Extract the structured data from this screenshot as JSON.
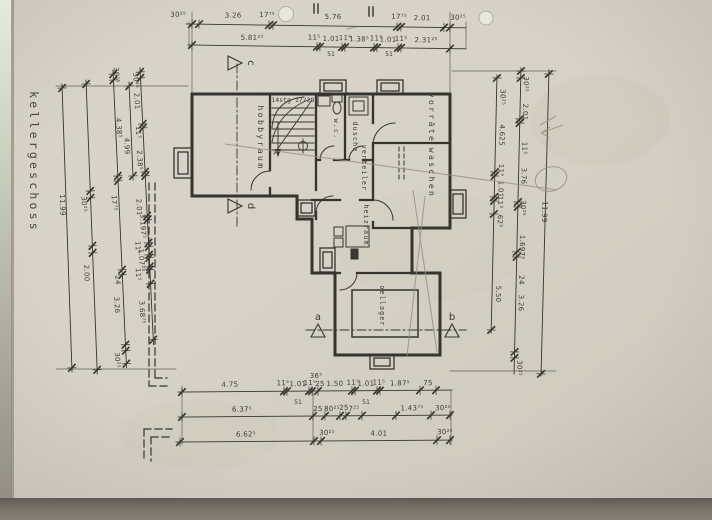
{
  "title": "kellergeschoss",
  "rooms": {
    "hobbyraum": "hobbyraum",
    "stairs": "14stg 17/28",
    "wc": "w.c.",
    "dusche": "dusche",
    "vorraete": "vorräte",
    "waschen": "waschen",
    "verteiler": "verteiler",
    "heizraum": "heizraum",
    "oellager": "oellager"
  },
  "section_markers": {
    "a": "a",
    "b": "b",
    "c": "c",
    "d": "d"
  },
  "dims": {
    "top1": [
      "30²⁵",
      "3.26",
      "17⁷⁵",
      "5.76",
      "17⁷⁵",
      "2.01",
      "30²⁵"
    ],
    "top2": [
      "5.81²⁵",
      "11⁵",
      "1.01",
      "11⁵",
      "1.38⁵",
      "11⁵",
      "1.01",
      "11⁵",
      "2.31²⁵"
    ],
    "top2_sub": [
      "51",
      "51"
    ],
    "bottom1": [
      "4.75",
      "11⁵",
      "1.01",
      "11⁵",
      "25",
      "1.50",
      "11⁵",
      "1.01",
      "11⁵",
      "1.87⁵",
      "75"
    ],
    "bottom1_above": [
      "36⁵"
    ],
    "bottom1_sub": [
      "51",
      "51"
    ],
    "bottom2": [
      "6.37⁵",
      "25",
      "80²⁵",
      "25",
      "7²⁵",
      "1.43⁷⁵",
      "30²⁵"
    ],
    "bottom3": [
      "6.62⁵",
      "30²⁵",
      "4.01",
      "30²⁵"
    ],
    "left1": [
      "11.99"
    ],
    "left2": [
      "30²⁵",
      "2.00"
    ],
    "left3": [
      "30²⁵",
      "4.38⁵",
      "17⁷⁵",
      "24",
      "3.26",
      "30²⁵"
    ],
    "left4": [
      "30²⁵",
      "2.01",
      "11⁵",
      "2.38⁵",
      "2.01",
      "3.197⁵",
      "11⁵",
      "1.07²⁵",
      "11⁵",
      "3.68⁷⁵"
    ],
    "left5": [
      "4.99"
    ],
    "right1": [
      "30²⁵",
      "4.625",
      "11⁵",
      "1.01",
      "11⁵",
      "62⁵",
      "5.50"
    ],
    "right2": [
      "30²⁵",
      "2.01",
      "11⁵",
      "3.76",
      "30²⁵",
      "1.697⁵",
      "24",
      "3.26",
      "30²⁵"
    ],
    "right3": [
      "11.99"
    ]
  }
}
